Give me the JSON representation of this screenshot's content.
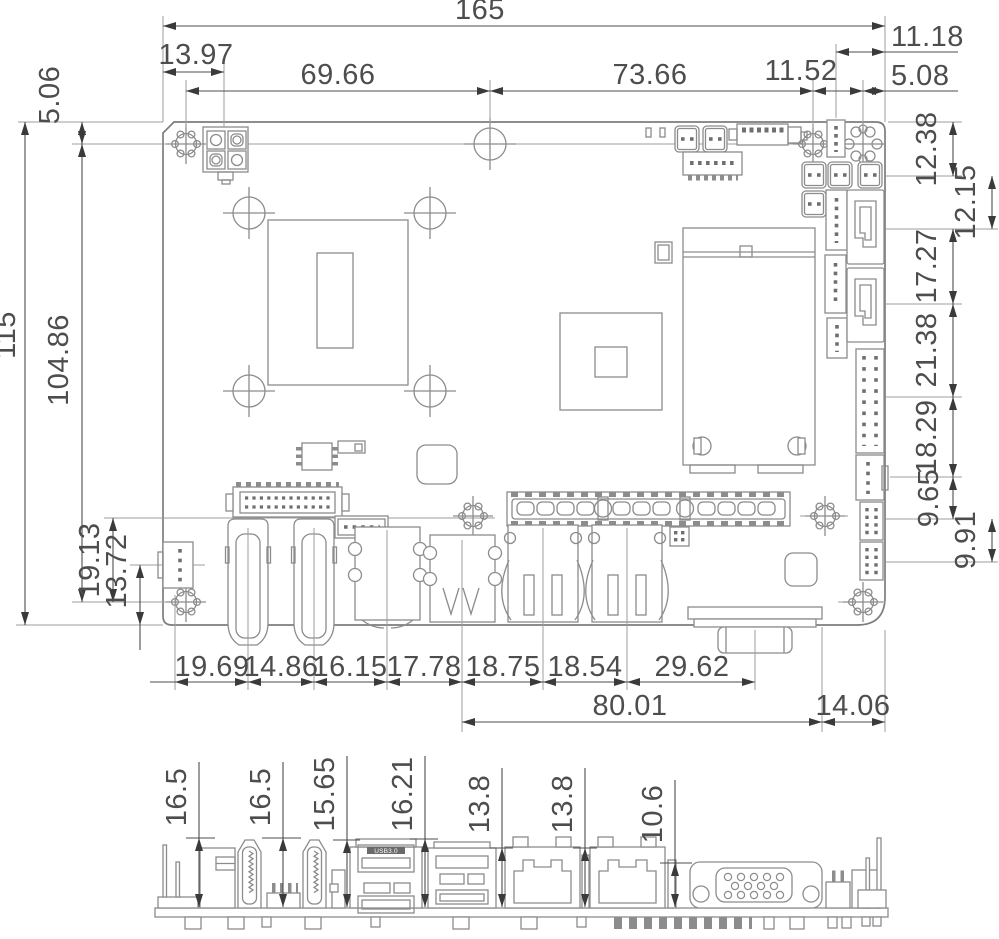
{
  "drawing": {
    "top_view": {
      "width_dims": {
        "overall": "165",
        "power_conn_x": "13.97",
        "hole_span_left": "69.66",
        "hole_span_right": "73.66",
        "hole_pair_gap": "11.52",
        "conn_from_edge": "11.18",
        "hole_to_edge": "5.08"
      },
      "height_dims": {
        "overall": "115",
        "top_row_y": "5.06",
        "hole_span": "104.86",
        "header_row_y": "19.13",
        "conn_row_y": "13.72"
      },
      "right_edge_dims": [
        "12.38",
        "12.15",
        "17.27",
        "21.38",
        "18.29",
        "9.65",
        "9.91"
      ],
      "bottom_conn_dims": [
        "19.69",
        "14.86",
        "16.15",
        "17.78",
        "18.75",
        "18.54",
        "29.62"
      ],
      "bottom_span_dims": [
        "80.01",
        "14.06"
      ]
    },
    "side_view": {
      "height_dims": [
        "16.5",
        "16.5",
        "15.65",
        "16.21",
        "13.8",
        "13.8",
        "10.6"
      ],
      "usb_label": "USB3.0"
    }
  }
}
